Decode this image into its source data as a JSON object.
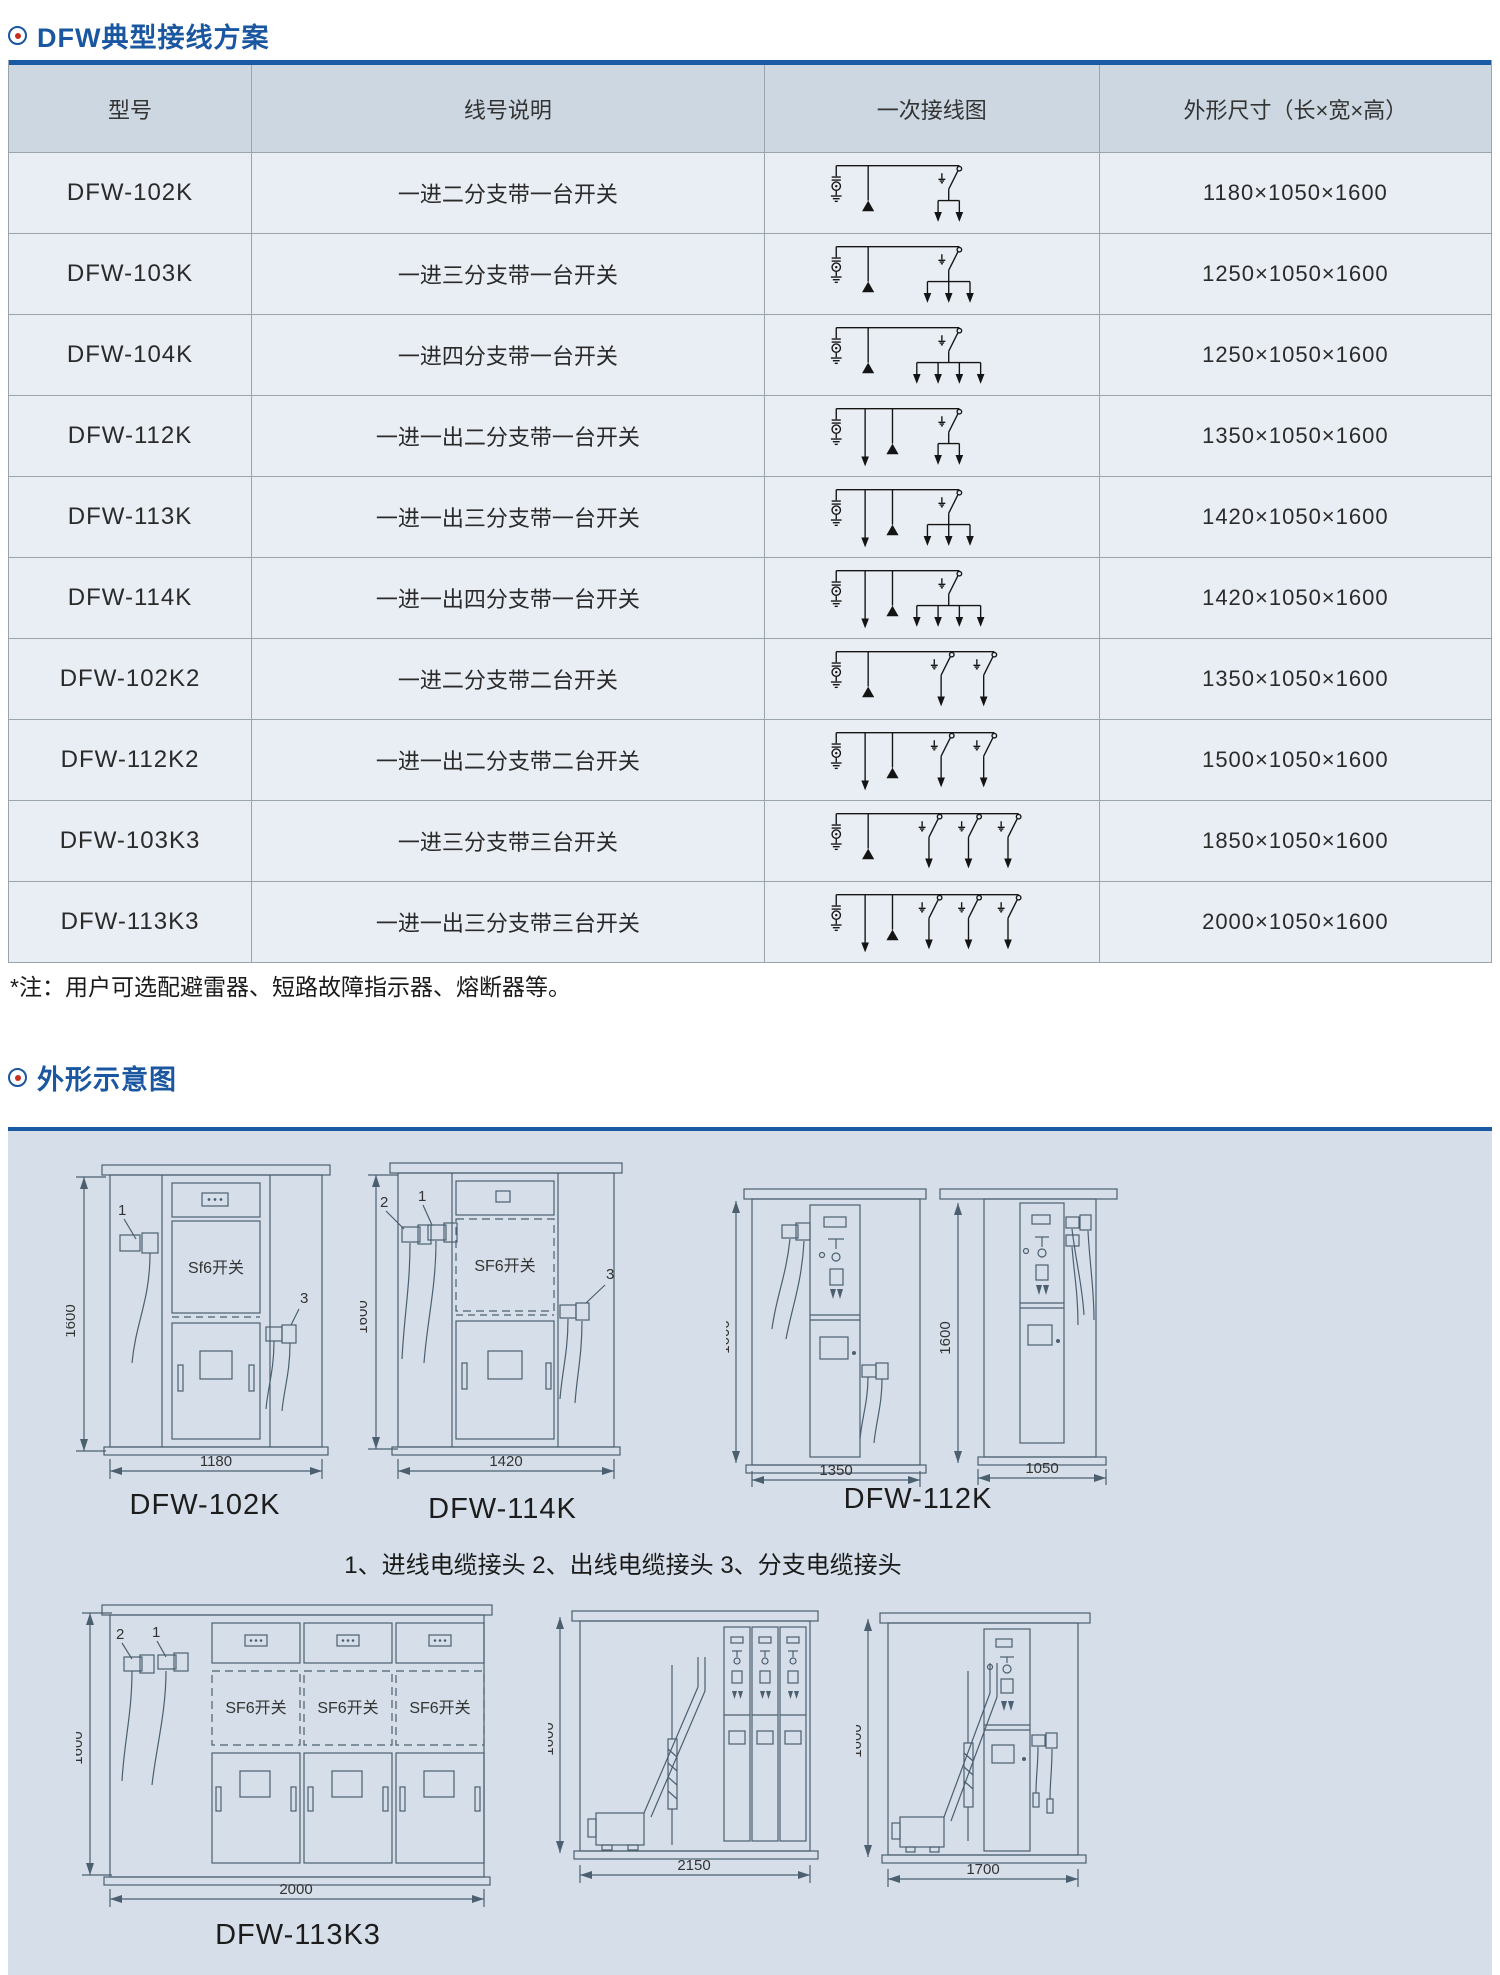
{
  "section1": {
    "title": "DFW典型接线方案",
    "table": {
      "headers": [
        "型号",
        "线号说明",
        "一次接线图",
        "外形尺寸（长×宽×高）"
      ],
      "rows": [
        {
          "model": "DFW-102K",
          "desc": "一进二分支带一台开关",
          "dims": "1180×1050×1600",
          "diagram": {
            "outgoing": 0,
            "branches": 2,
            "switches": 1
          }
        },
        {
          "model": "DFW-103K",
          "desc": "一进三分支带一台开关",
          "dims": "1250×1050×1600",
          "diagram": {
            "outgoing": 0,
            "branches": 3,
            "switches": 1
          }
        },
        {
          "model": "DFW-104K",
          "desc": "一进四分支带一台开关",
          "dims": "1250×1050×1600",
          "diagram": {
            "outgoing": 0,
            "branches": 4,
            "switches": 1
          }
        },
        {
          "model": "DFW-112K",
          "desc": "一进一出二分支带一台开关",
          "dims": "1350×1050×1600",
          "diagram": {
            "outgoing": 1,
            "branches": 2,
            "switches": 1
          }
        },
        {
          "model": "DFW-113K",
          "desc": "一进一出三分支带一台开关",
          "dims": "1420×1050×1600",
          "diagram": {
            "outgoing": 1,
            "branches": 3,
            "switches": 1
          }
        },
        {
          "model": "DFW-114K",
          "desc": "一进一出四分支带一台开关",
          "dims": "1420×1050×1600",
          "diagram": {
            "outgoing": 1,
            "branches": 4,
            "switches": 1
          }
        },
        {
          "model": "DFW-102K2",
          "desc": "一进二分支带二台开关",
          "dims": "1350×1050×1600",
          "diagram": {
            "outgoing": 0,
            "branches": 2,
            "switches": 2
          }
        },
        {
          "model": "DFW-112K2",
          "desc": "一进一出二分支带二台开关",
          "dims": "1500×1050×1600",
          "diagram": {
            "outgoing": 1,
            "branches": 2,
            "switches": 2
          }
        },
        {
          "model": "DFW-103K3",
          "desc": "一进三分支带三台开关",
          "dims": "1850×1050×1600",
          "diagram": {
            "outgoing": 0,
            "branches": 3,
            "switches": 3
          }
        },
        {
          "model": "DFW-113K3",
          "desc": "一进一出三分支带三台开关",
          "dims": "2000×1050×1600",
          "diagram": {
            "outgoing": 1,
            "branches": 3,
            "switches": 3
          }
        }
      ]
    },
    "note": "*注：用户可选配避雷器、短路故障指示器、熔断器等。"
  },
  "section2": {
    "title": "外形示意图",
    "legend": "1、进线电缆接头  2、出线电缆接头  3、分支电缆接头",
    "callouts": {
      "in": "1",
      "out": "2",
      "branch": "3"
    },
    "drawings": [
      {
        "caption": "DFW-102K",
        "h": "1600",
        "w": "1180",
        "label": "Sf6开关"
      },
      {
        "caption": "DFW-114K",
        "h": "1600",
        "w": "1420",
        "label": "SF6开关"
      },
      {
        "caption": "DFW-112K",
        "h": "1600",
        "w": "1350"
      },
      {
        "h": "1600",
        "w": "1050"
      },
      {
        "caption": "DFW-113K3",
        "h": "1600",
        "w": "2000",
        "label": "SF6开关"
      },
      {
        "h": "1600",
        "w": "2150"
      },
      {
        "h": "1600",
        "w": "1700"
      }
    ]
  },
  "colors": {
    "accent_blue": "#1a5aa5",
    "header_bg": "#ccd7e1",
    "row_bg": "#e9eef4",
    "panel_bg": "#d6dfe9",
    "bullet_red": "#c43022"
  }
}
